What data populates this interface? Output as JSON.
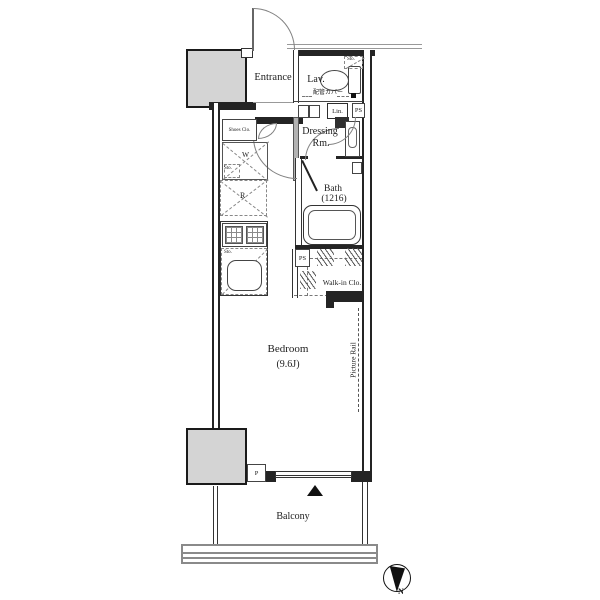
{
  "labels": {
    "entrance": "Entrance",
    "lavatory": "Lav.",
    "storage_lav": "Sto.",
    "pipe_cover": "配管カバー",
    "linen": "Lin.",
    "pipe_space_upper": "PS",
    "shoes_closet": "Shoes Clo.",
    "washer": "W",
    "storage_washer": "Sto.",
    "dressing_room_line1": "Dressing",
    "dressing_room_line2": "Rm.",
    "refrigerator": "R",
    "bath_line1": "Bath",
    "bath_line2": "(1216)",
    "storage_kitchen": "Sto.",
    "pipe_space_wic": "PS",
    "walk_in_closet": "Walk-in Clo.",
    "bedroom": "Bedroom",
    "bedroom_size": "(9.6J)",
    "picture_rail": "Picture Rail",
    "pipe_shaft": "P",
    "balcony": "Balcony",
    "compass_north": "N"
  },
  "colors": {
    "wall_dark": "#242424",
    "gray_fill": "#d4d4d4",
    "mid_gray_wall": "#b3b3b3",
    "rail_gray": "#8a8a8a",
    "arc_gray": "#828282",
    "text": "#1d1d1d"
  }
}
